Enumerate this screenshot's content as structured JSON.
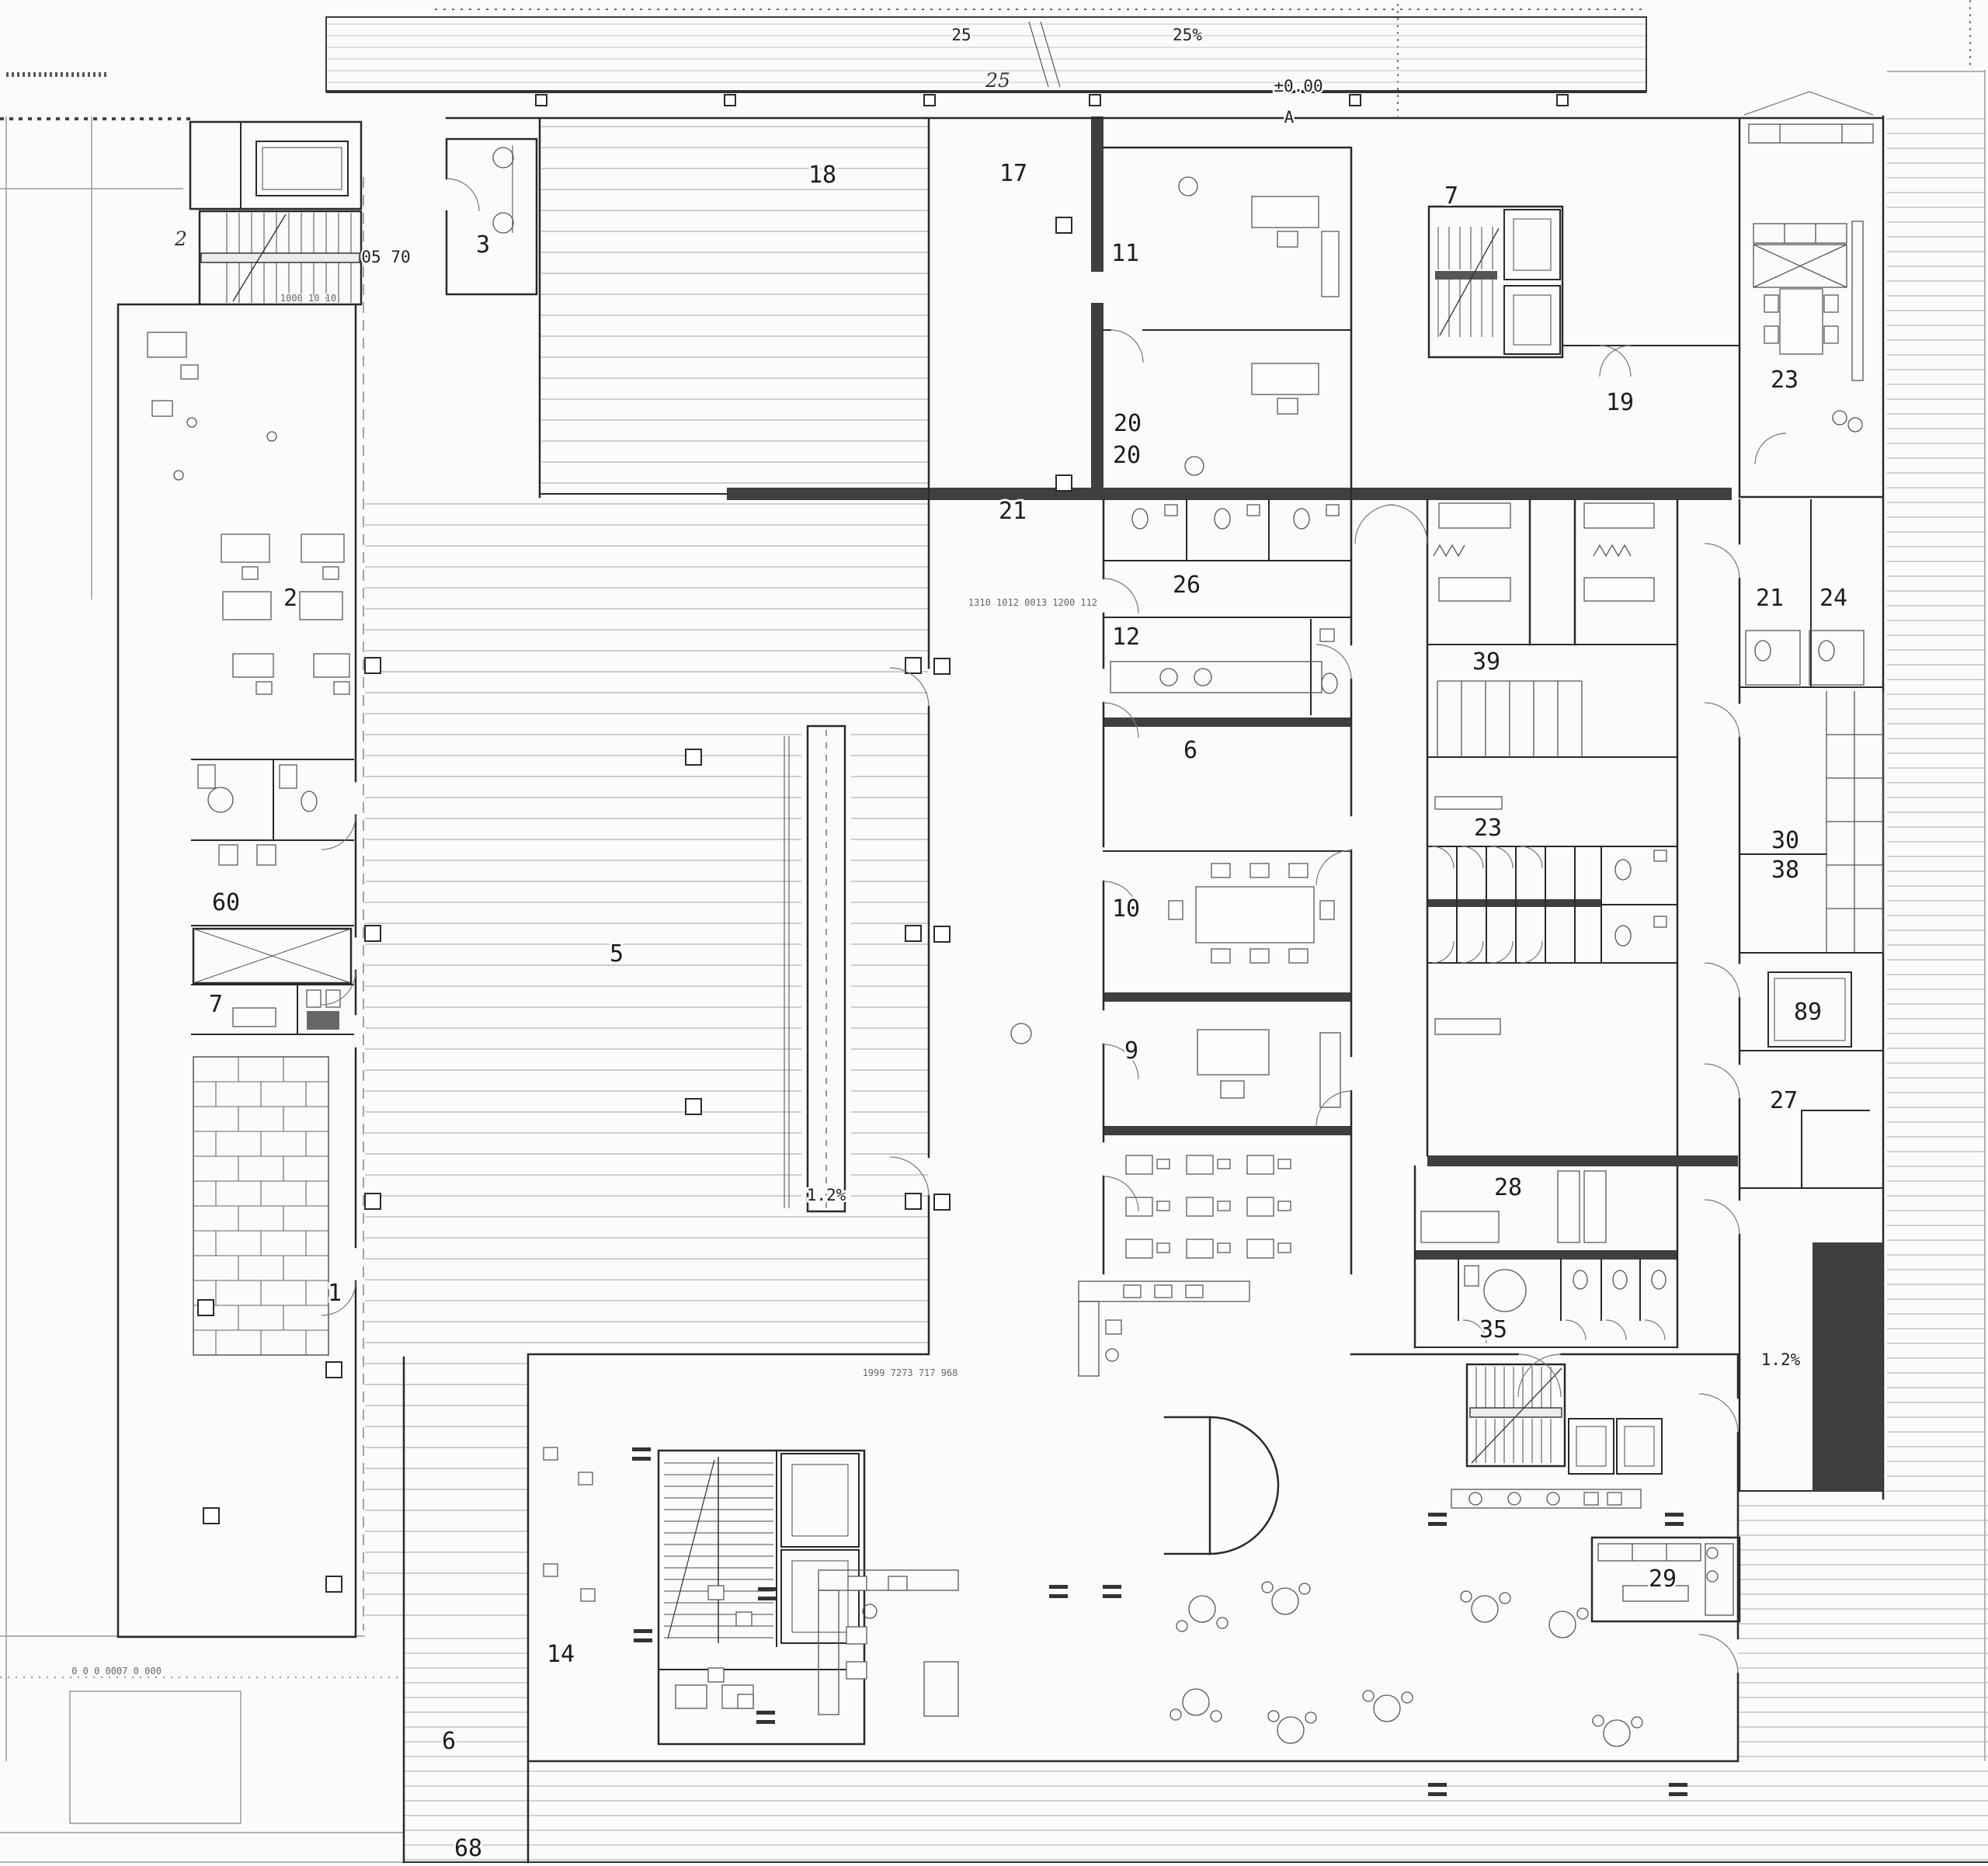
{
  "document": {
    "type": "architectural floor plan",
    "view": "ground floor plan",
    "style": "monochrome CAD line drawing with hatched halls and decks"
  },
  "colors": {
    "paper": "#fbfbfa",
    "ink": "#2a2a2a",
    "poche_wall": "#3f3f3f",
    "hatch_hall": "#b4b4b4",
    "hatch_deck": "#a9a9a9",
    "hatch_canopy": "#c4c4c4",
    "pool_grid": "#777777"
  },
  "labels": {
    "canopy_left": "25",
    "canopy_slope": "25%",
    "canopy_script": "25",
    "level": "±0.00",
    "marker_a": "A",
    "boundary_2": "2",
    "dim_0570": "05 70",
    "r18": "18",
    "r17": "17",
    "r11": "11",
    "r20a": "20",
    "r20b": "20",
    "r21c": "21",
    "r26": "26",
    "r12": "12",
    "r6c": "6",
    "r10": "10",
    "r9": "9",
    "r2": "2",
    "r3": "3",
    "r60": "60",
    "r7w": "7",
    "r5": "5",
    "r1": "1",
    "r7e": "7",
    "r19": "19",
    "r23e": "23",
    "r21r": "21",
    "r24r": "24",
    "r39": "39",
    "r23w": "23",
    "r30": "30",
    "r38": "38",
    "r89": "89",
    "r27": "27",
    "r28": "28",
    "r35": "35",
    "r29": "29",
    "r14": "14",
    "r6s": "6",
    "r68": "68",
    "slope_a": "1.2%",
    "slope_b": "1.2%",
    "dim_a": "1310 1012 0013 1200 112",
    "dim_b": "1999 7273 717 968",
    "dim_c": "1000 10 10",
    "dim_d": "0 0 0 0007 0 000"
  }
}
